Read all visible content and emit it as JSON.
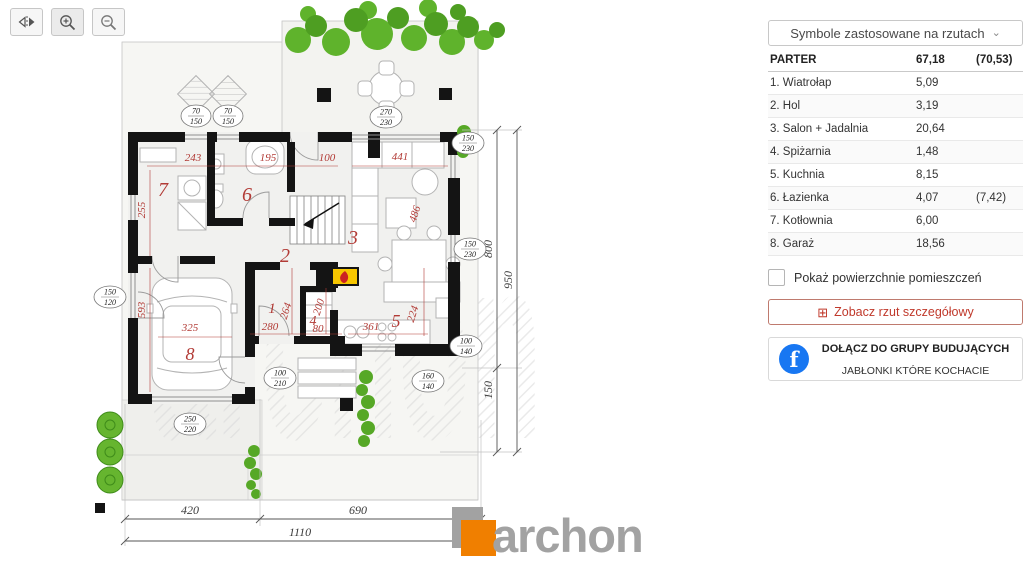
{
  "toolbar": {
    "flip_icon": "flip-horizontal-icon",
    "zoom_in_icon": "zoom-in-icon",
    "zoom_out_icon": "zoom-out-icon"
  },
  "panel": {
    "dropdown_label": "Symbole zastosowane na rzutach",
    "table": {
      "header": {
        "name": "PARTER",
        "area": "67,18",
        "area_alt": "(70,53)"
      },
      "rows": [
        {
          "name": "1. Wiatrołap",
          "area": "5,09",
          "area_alt": ""
        },
        {
          "name": "2. Hol",
          "area": "3,19",
          "area_alt": ""
        },
        {
          "name": "3. Salon + Jadalnia",
          "area": "20,64",
          "area_alt": ""
        },
        {
          "name": "4. Spiżarnia",
          "area": "1,48",
          "area_alt": ""
        },
        {
          "name": "5. Kuchnia",
          "area": "8,15",
          "area_alt": ""
        },
        {
          "name": "6. Łazienka",
          "area": "4,07",
          "area_alt": "(7,42)"
        },
        {
          "name": "7. Kotłownia",
          "area": "6,00",
          "area_alt": ""
        },
        {
          "name": "8. Garaż",
          "area": "18,56",
          "area_alt": ""
        }
      ]
    },
    "checkbox_label": "Pokaż powierzchnie pomieszczeń",
    "detail_button_label": "Zobacz rzut szczegółowy",
    "facebook": {
      "line1": "DOŁĄCZ DO GRUPY BUDUJĄCYCH",
      "line2": "JABŁONKI KTÓRE KOCHACIE"
    }
  },
  "icons": {
    "chevron": "⌄",
    "detail": "⊞",
    "facebook": "f"
  },
  "plan": {
    "rooms": {
      "r1": "1",
      "r2": "2",
      "r3": "3",
      "r4": "4",
      "r5": "5",
      "r6": "6",
      "r7": "7",
      "r8": "8"
    },
    "dims_red": {
      "d243": "243",
      "d195": "195",
      "d100": "100",
      "d441": "441",
      "d255": "255",
      "d593": "593",
      "d486": "486",
      "d280": "280",
      "d264": "264",
      "d200": "200",
      "d80": "80",
      "d361": "361",
      "d224": "224",
      "d325": "325"
    },
    "dims_black": {
      "b420": "420",
      "b690": "690",
      "b1110": "1110",
      "b800": "800",
      "b950": "950",
      "b150": "150"
    },
    "ovals": {
      "o70_150": {
        "a": "70",
        "b": "150"
      },
      "o270_230": {
        "a": "270",
        "b": "230"
      },
      "o150_230": {
        "a": "150",
        "b": "230"
      },
      "o150_120": {
        "a": "150",
        "b": "120"
      },
      "o100_140": {
        "a": "100",
        "b": "140"
      },
      "o160_140": {
        "a": "160",
        "b": "140"
      },
      "o100_210": {
        "a": "100",
        "b": "210"
      },
      "o250_220": {
        "a": "250",
        "b": "220"
      }
    },
    "watermark": {
      "big": "archon",
      "fragment": "PRAC"
    }
  },
  "logo": {
    "text": "archon"
  },
  "colors": {
    "accent_red": "#b23b36",
    "wall_black": "#141414",
    "plant_green": "#5fb32c",
    "facebook_blue": "#1877f2",
    "logo_orange": "#f07f00",
    "logo_gray": "#a2a2a2",
    "button_red": "#c0392b"
  }
}
